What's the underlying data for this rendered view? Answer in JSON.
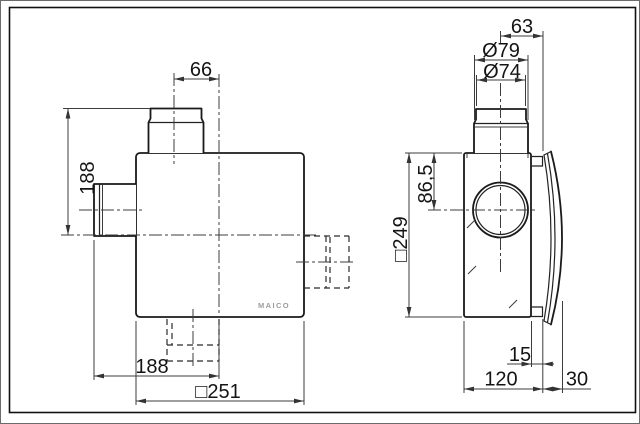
{
  "drawing": {
    "brand": "MAICO",
    "front_view": {
      "duct_offset_mm": "66",
      "height_mm": "188",
      "spigot_offset_mm": "188",
      "width_mm": "□251"
    },
    "side_view": {
      "duct_to_wall_mm": "63",
      "duct_outer_dia": "Ø79",
      "duct_inner_dia": "Ø74",
      "top_to_axis_mm": "86,5",
      "height_mm": "□249",
      "flange_gap_mm": "15",
      "depth_mm": "120",
      "cover_depth_mm": "30"
    }
  }
}
